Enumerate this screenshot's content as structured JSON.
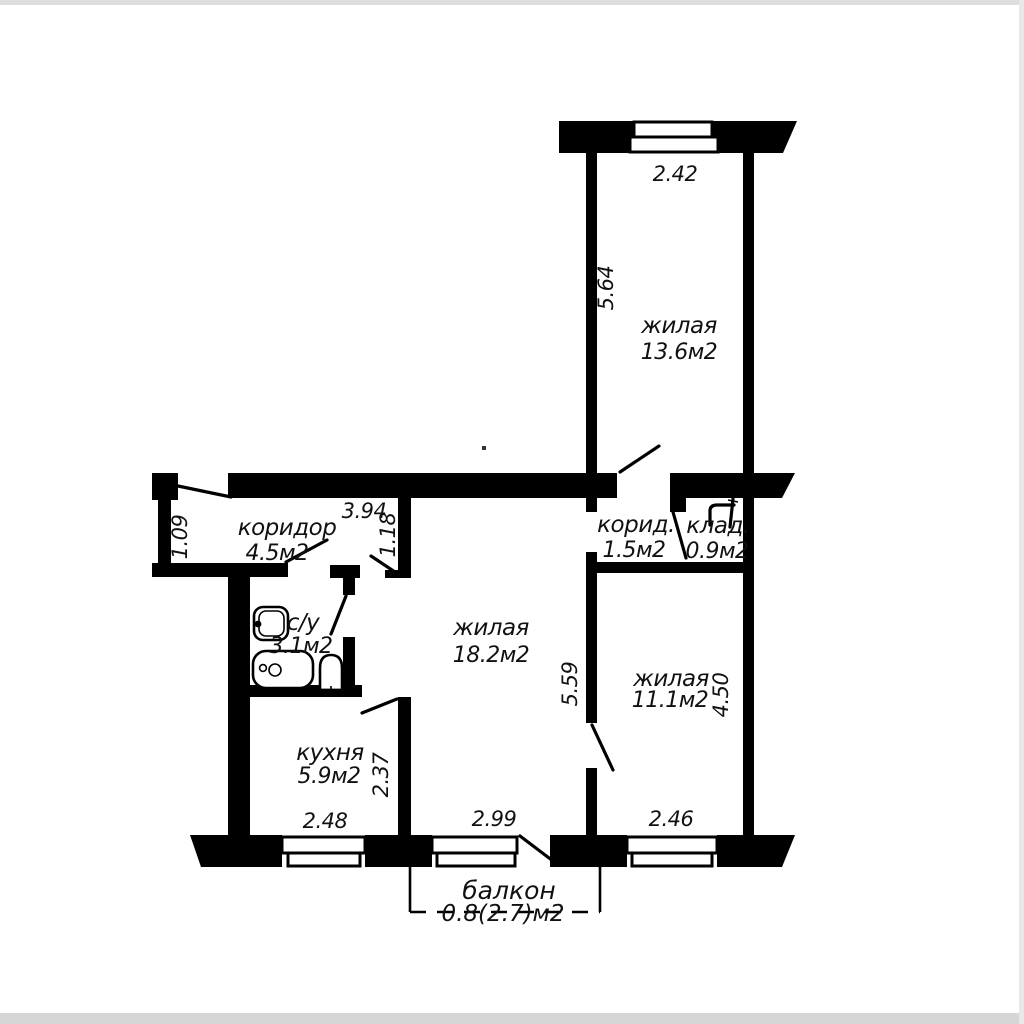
{
  "rooms": {
    "living_top": {
      "label": "жилая",
      "area": "13.6м2"
    },
    "living_main": {
      "label": "жилая",
      "area": "18.2м2"
    },
    "living_right": {
      "label": "жилая",
      "area": "11.1м2"
    },
    "hall": {
      "label": "коридор",
      "area": "4.5м2"
    },
    "hall_small": {
      "label": "корид.",
      "area": "1.5м2"
    },
    "closet": {
      "label": "клад.",
      "area": "0.9м2"
    },
    "bathroom": {
      "label": "с/у",
      "area": "3.1м2"
    },
    "kitchen": {
      "label": "кухня",
      "area": "5.9м2"
    },
    "balcony": {
      "label": "балкон",
      "area": "0.8(2.7)м2"
    }
  },
  "dimensions": {
    "living_top_width": "2.42",
    "living_top_height": "5.64",
    "hall_width": "3.94",
    "hall_wall": "1.18",
    "hall_left_height": "1.09",
    "living_main_height": "5.59",
    "living_right_height": "4.50",
    "kitchen_height": "2.37",
    "kitchen_width": "2.48",
    "living_main_width": "2.99",
    "living_right_width": "2.46"
  },
  "colors": {
    "wall": "#000000",
    "paper": "#ffffff",
    "faded_text": "#8c8c8c"
  }
}
